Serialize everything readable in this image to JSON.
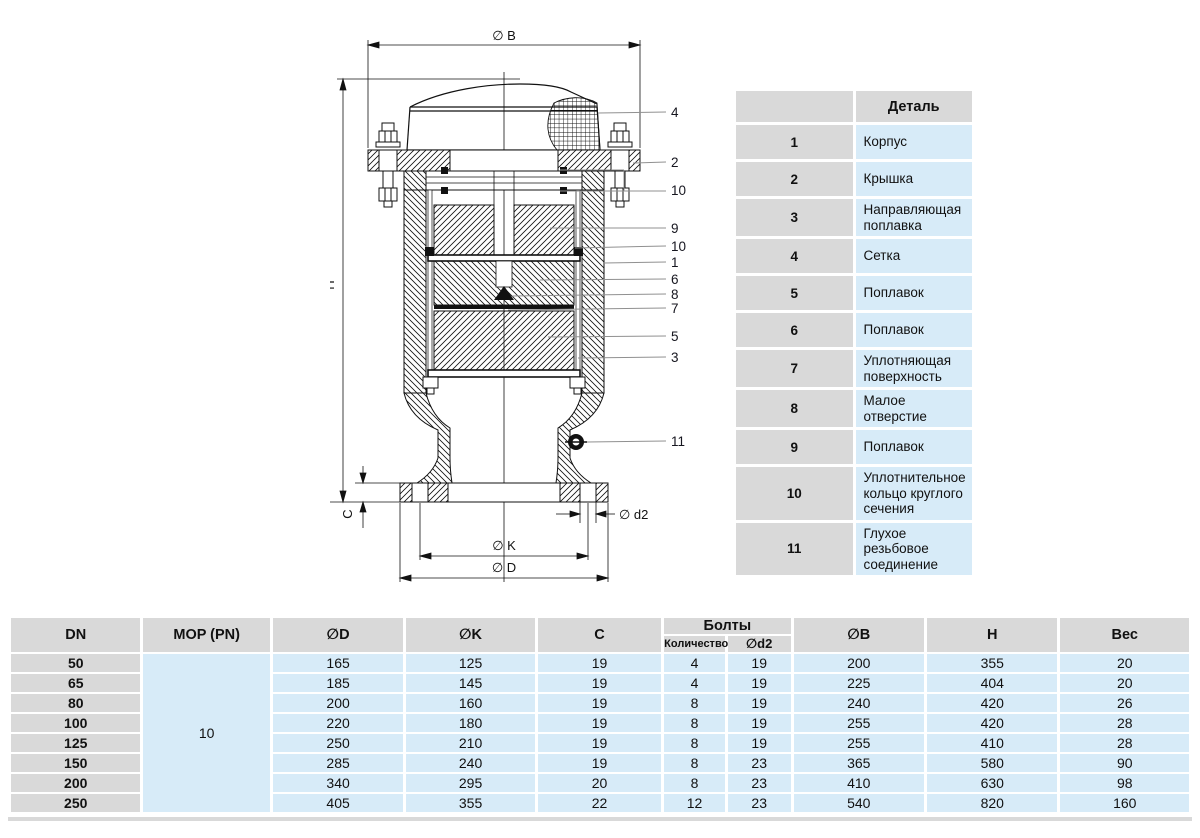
{
  "diagram": {
    "dims": {
      "b": "∅ B",
      "h": "H",
      "c": "C",
      "d2": "∅ d2",
      "k": "∅ K",
      "d": "∅ D"
    },
    "callouts": [
      {
        "label": "4"
      },
      {
        "label": "2"
      },
      {
        "label": "10"
      },
      {
        "label": "9"
      },
      {
        "label": "10"
      },
      {
        "label": "1"
      },
      {
        "label": "6"
      },
      {
        "label": "8"
      },
      {
        "label": "7"
      },
      {
        "label": "5"
      },
      {
        "label": "3"
      },
      {
        "label": "11"
      }
    ]
  },
  "parts_table": {
    "header": "Деталь",
    "rows": [
      {
        "num": "1",
        "name": "Корпус"
      },
      {
        "num": "2",
        "name": "Крышка"
      },
      {
        "num": "3",
        "name": "Направляющая поплавка"
      },
      {
        "num": "4",
        "name": "Сетка"
      },
      {
        "num": "5",
        "name": "Поплавок"
      },
      {
        "num": "6",
        "name": "Поплавок"
      },
      {
        "num": "7",
        "name": "Уплотняющая поверхность"
      },
      {
        "num": "8",
        "name": "Малое отверстие"
      },
      {
        "num": "9",
        "name": "Поплавок"
      },
      {
        "num": "10",
        "name": "Уплотнительное кольцо круглого сечения"
      },
      {
        "num": "11",
        "name": "Глухое резьбовое соединение"
      }
    ]
  },
  "spec_table": {
    "headers": {
      "dn": "DN",
      "mop": "MOP (PN)",
      "d": "∅D",
      "k": "∅K",
      "c": "C",
      "bolts": "Болты",
      "qty": "Количество",
      "d2": "∅d2",
      "b": "∅B",
      "h": "H",
      "weight": "Вес"
    },
    "mop_value": "10",
    "rows": [
      {
        "dn": "50",
        "d": "165",
        "k": "125",
        "c": "19",
        "qty": "4",
        "d2": "19",
        "b": "200",
        "h": "355",
        "weight": "20"
      },
      {
        "dn": "65",
        "d": "185",
        "k": "145",
        "c": "19",
        "qty": "4",
        "d2": "19",
        "b": "225",
        "h": "404",
        "weight": "20"
      },
      {
        "dn": "80",
        "d": "200",
        "k": "160",
        "c": "19",
        "qty": "8",
        "d2": "19",
        "b": "240",
        "h": "420",
        "weight": "26"
      },
      {
        "dn": "100",
        "d": "220",
        "k": "180",
        "c": "19",
        "qty": "8",
        "d2": "19",
        "b": "255",
        "h": "420",
        "weight": "28"
      },
      {
        "dn": "125",
        "d": "250",
        "k": "210",
        "c": "19",
        "qty": "8",
        "d2": "19",
        "b": "255",
        "h": "410",
        "weight": "28"
      },
      {
        "dn": "150",
        "d": "285",
        "k": "240",
        "c": "19",
        "qty": "8",
        "d2": "23",
        "b": "365",
        "h": "580",
        "weight": "90"
      },
      {
        "dn": "200",
        "d": "340",
        "k": "295",
        "c": "20",
        "qty": "8",
        "d2": "23",
        "b": "410",
        "h": "630",
        "weight": "98"
      },
      {
        "dn": "250",
        "d": "405",
        "k": "355",
        "c": "22",
        "qty": "12",
        "d2": "23",
        "b": "540",
        "h": "820",
        "weight": "160"
      }
    ]
  },
  "colors": {
    "table_header_gray": "#d9d9d9",
    "table_cell_blue": "#d7ebf8",
    "leader_gray": "#909090",
    "line_black": "#111111"
  }
}
